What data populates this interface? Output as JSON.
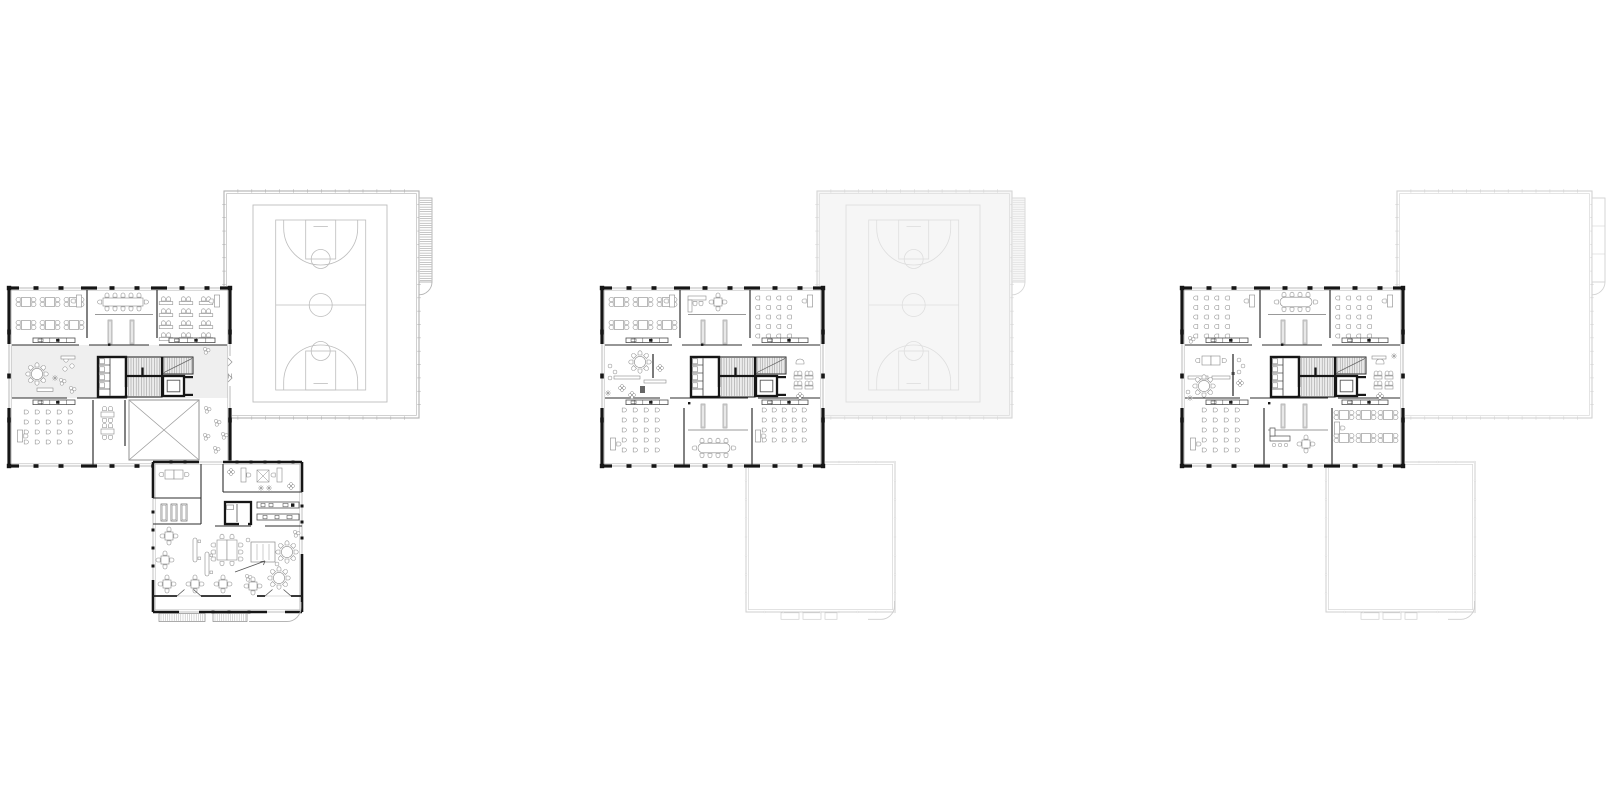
{
  "document": {
    "kind": "architectural-floor-plan-sheet",
    "background": "#ffffff",
    "canvas": {
      "width": 1612,
      "height": 806
    }
  },
  "palette": {
    "wall_black": "#161616",
    "wall_inner": "#2e2e2e",
    "window": "#b2b2b2",
    "furniture": "#8a8a8a",
    "furniture_dark": "#5f5f5f",
    "counter": "#4f4f4f",
    "tint": "#efefef",
    "stair_fill": "#ececec",
    "stair_line": "#9a9a9a",
    "void_line": "#9c9c9c",
    "wing_outline": "#cfcfcf",
    "gym": {
      "ground": {
        "wall": "#b2b2b2",
        "court": "#bdbdbd",
        "hatch": "#8f8f8f",
        "fill": "#ffffff"
      },
      "faded": {
        "wall": "#d6d6d6",
        "court": "#dedede",
        "hatch": "#d8d8d8",
        "fill": "#f6f6f6"
      },
      "outline": {
        "wall": "#d2d2d2",
        "court": null,
        "hatch": null,
        "fill": "#ffffff"
      }
    }
  },
  "layout": {
    "origin_y": 288,
    "blocks": {
      "main": {
        "w": 221,
        "h": 178
      },
      "gym": {
        "dx": 215,
        "dy": -97,
        "w": 195,
        "h": 227
      },
      "wing": {
        "dx": 144,
        "dy": 174,
        "w": 149,
        "h": 150
      }
    }
  },
  "plans": [
    {
      "id": "ground-floor",
      "name": "floor-plan-ground",
      "dx": 9,
      "main_variant": "ground",
      "gym_style": "ground",
      "wing_style": "detailed"
    },
    {
      "id": "first-floor",
      "name": "floor-plan-first",
      "dx": 602,
      "main_variant": "upper",
      "gym_style": "faded",
      "wing_style": "outline"
    },
    {
      "id": "second-floor",
      "name": "floor-plan-second",
      "dx": 1182,
      "main_variant": "upper2",
      "gym_style": "outline",
      "wing_style": "outline"
    }
  ],
  "blocks_legend": [
    {
      "name": "classroom-block"
    },
    {
      "name": "sports-hall-with-basketball-court"
    },
    {
      "name": "entrance-wing"
    }
  ]
}
